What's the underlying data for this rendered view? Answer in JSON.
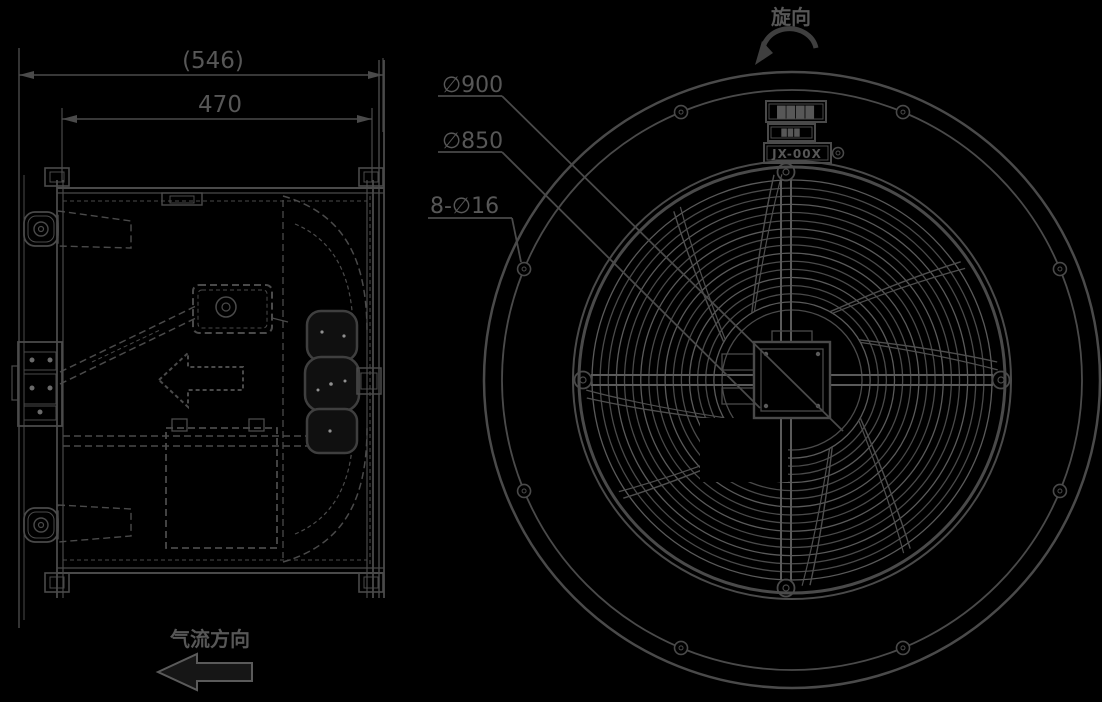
{
  "colors": {
    "background": "#000000",
    "line": "#4a4a4a",
    "line_light": "#5a5a5a",
    "text": "#575757"
  },
  "side_view": {
    "dim_overall": "(546)",
    "dim_depth": "470",
    "airflow_label": "气流方向"
  },
  "front_view": {
    "dia_outer_label": "∅900",
    "dia_bolt_circle_label": "∅850",
    "bolt_holes_label": "8-∅16",
    "rotation_label": "旋向",
    "nameplate": {
      "row1": "████",
      "row2": "███",
      "row3": "JX-00X"
    }
  }
}
